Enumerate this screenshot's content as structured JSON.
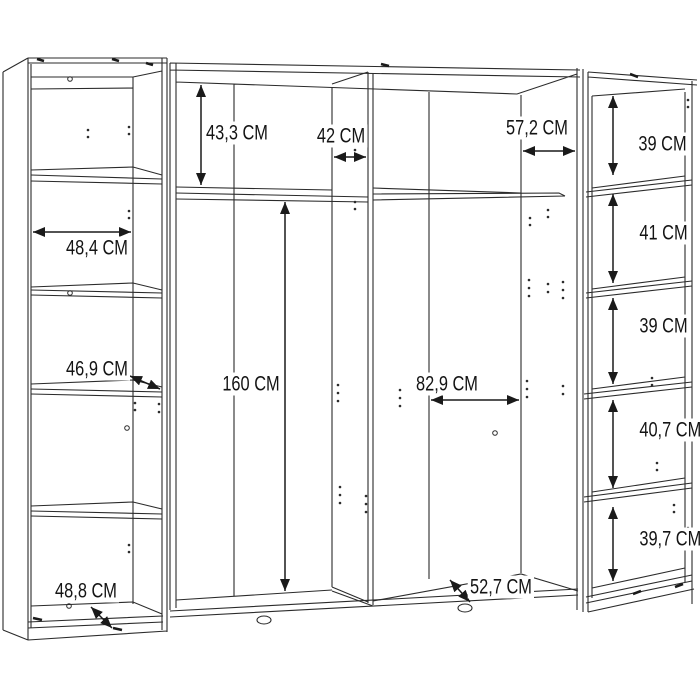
{
  "diagram": {
    "kind": "wardrobe-assembly-dimension-drawing",
    "unit": "CM",
    "colors": {
      "background": "#ffffff",
      "line": "#2b2b2b",
      "text": "#141414"
    }
  },
  "labels": [
    {
      "id": "top-left-compartment-height",
      "text": "43,3 CM"
    },
    {
      "id": "divider-width",
      "text": "42 CM"
    },
    {
      "id": "right-compartment-top-width",
      "text": "57,2 CM"
    },
    {
      "id": "right-tower-shelf-1-height",
      "text": "39 CM"
    },
    {
      "id": "left-tower-inner-width",
      "text": "48,4 CM"
    },
    {
      "id": "right-tower-shelf-2-height",
      "text": "41 CM"
    },
    {
      "id": "left-tower-shelf-depth",
      "text": "46,9 CM"
    },
    {
      "id": "right-tower-shelf-3-height",
      "text": "39 CM"
    },
    {
      "id": "main-interior-height",
      "text": "160 CM"
    },
    {
      "id": "right-compartment-width",
      "text": "82,9 CM"
    },
    {
      "id": "right-tower-shelf-4-height",
      "text": "40,7 CM"
    },
    {
      "id": "right-tower-shelf-5-height",
      "text": "39,7 CM"
    },
    {
      "id": "left-tower-bottom-depth",
      "text": "48,8 CM"
    },
    {
      "id": "bottom-panel-depth",
      "text": "52,7 CM"
    }
  ]
}
